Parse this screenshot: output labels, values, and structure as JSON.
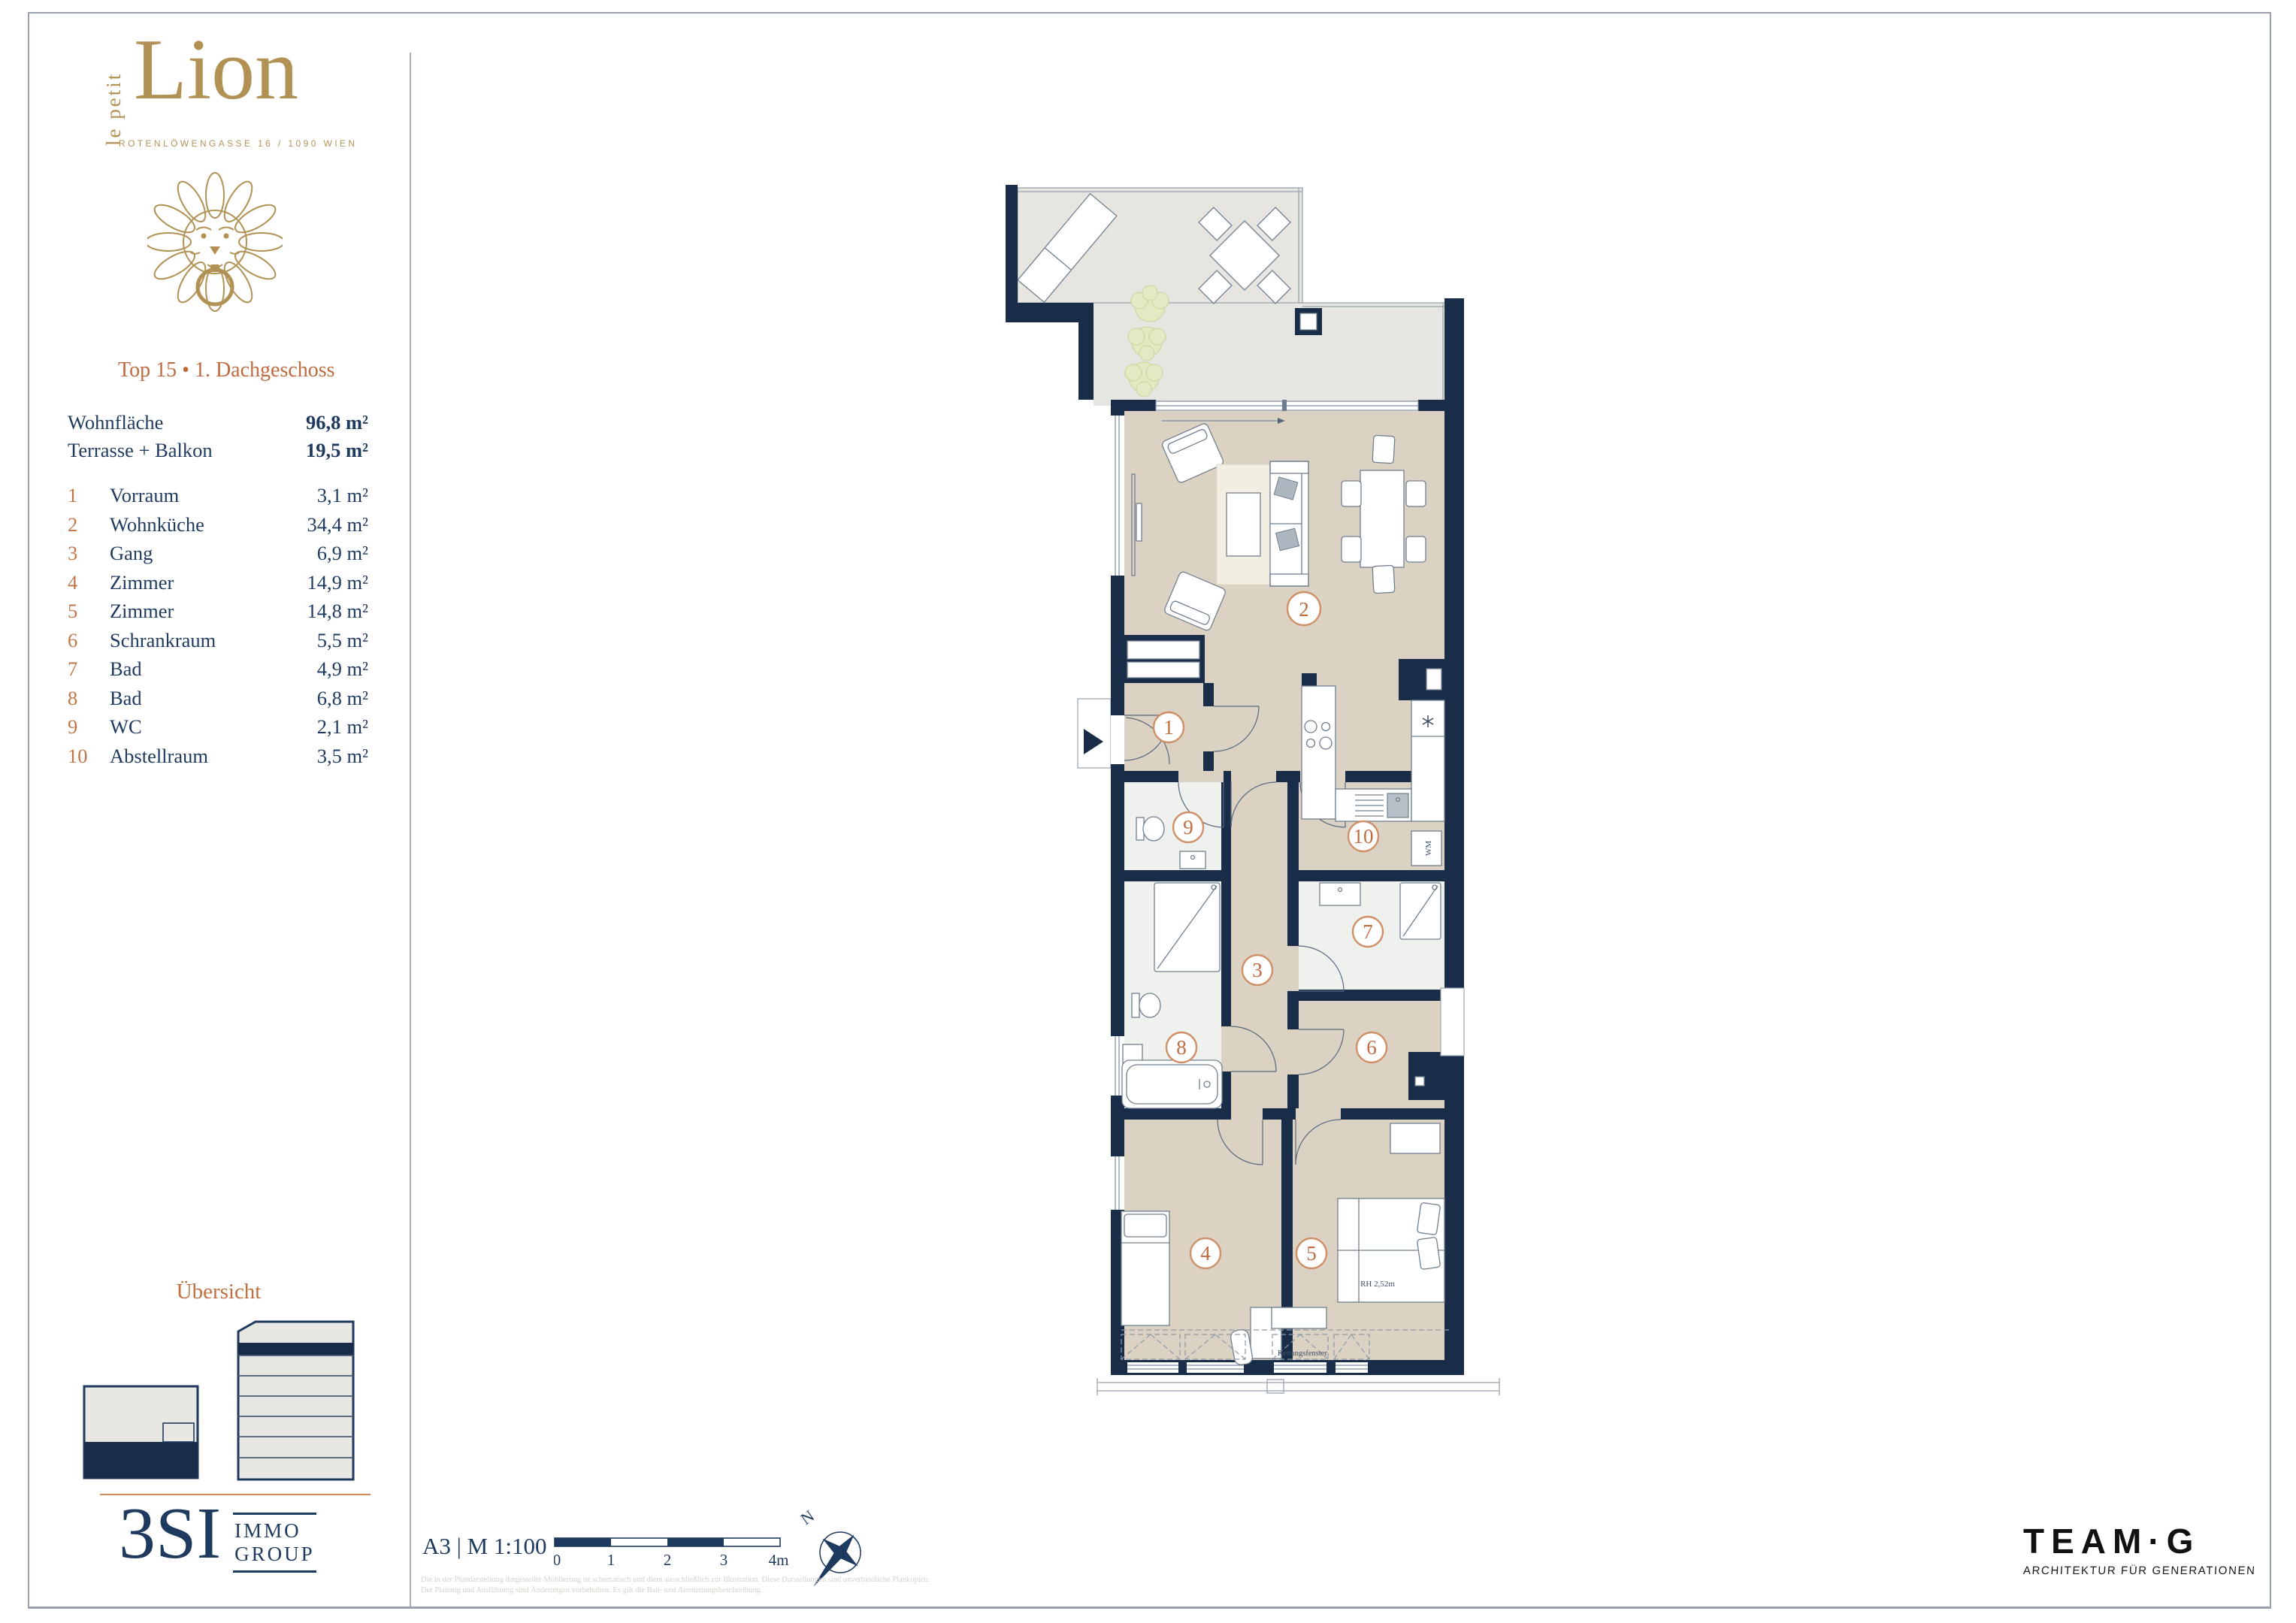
{
  "colors": {
    "wall_navy": "#192c48",
    "text_navy": "#1e3a5f",
    "accent_orange": "#c06a3f",
    "brand_gold": "#b29254",
    "terrace_floor": "#e6e5e0",
    "interior_floor": "#dcd2c3",
    "bath_floor": "#eff1ef",
    "frame_gray": "#97a0ac"
  },
  "brand": {
    "prefix": "le petit",
    "name": "Lion",
    "address": "ROTENLÖWENGASSE 16 / 1090 WIEN"
  },
  "unit": {
    "title": "Top 15 • 1. Dachgeschoss"
  },
  "summary": [
    {
      "label": "Wohnfläche",
      "value": "96,8 m²"
    },
    {
      "label": "Terrasse + Balkon",
      "value": "19,5 m²"
    }
  ],
  "rooms": [
    {
      "num": "1",
      "name": "Vorraum",
      "area": "3,1 m²"
    },
    {
      "num": "2",
      "name": "Wohnküche",
      "area": "34,4 m²"
    },
    {
      "num": "3",
      "name": "Gang",
      "area": "6,9 m²"
    },
    {
      "num": "4",
      "name": "Zimmer",
      "area": "14,9 m²"
    },
    {
      "num": "5",
      "name": "Zimmer",
      "area": "14,8 m²"
    },
    {
      "num": "6",
      "name": "Schrankraum",
      "area": "5,5 m²"
    },
    {
      "num": "7",
      "name": "Bad",
      "area": "4,9 m²"
    },
    {
      "num": "8",
      "name": "Bad",
      "area": "6,8 m²"
    },
    {
      "num": "9",
      "name": "WC",
      "area": "2,1 m²"
    },
    {
      "num": "10",
      "name": "Abstellraum",
      "area": "3,5 m²"
    }
  ],
  "overview": {
    "heading": "Übersicht"
  },
  "logo3si": {
    "name": "3SI",
    "line1": "IMMO",
    "line2": "GROUP"
  },
  "footer": {
    "sheet": "A3 | M 1:100",
    "scale_ticks": [
      "0",
      "1",
      "2",
      "3",
      "4m"
    ],
    "north": "N",
    "disclaimer1": "Die in der Plandarstellung dargestellte Möblierung ist schematisch und dient ausschließlich zur Illustration. Diese Darstellungen sind unverbindliche Plankopien.",
    "disclaimer2": "Der Planung und Ausführung sind Änderungen vorbehalten. Es gilt die Bau- und Ausstattungsbeschreibung."
  },
  "team": {
    "name": "TEAM·G",
    "tagline": "ARCHITEKTUR FÜR GENERATIONEN"
  },
  "plan": {
    "badges": [
      "1",
      "2",
      "3",
      "4",
      "5",
      "6",
      "7",
      "8",
      "9",
      "10"
    ],
    "labels": {
      "wm": "WM",
      "room_height": "RH 2,52m",
      "rescue_window": "Rettungsfenster"
    }
  }
}
